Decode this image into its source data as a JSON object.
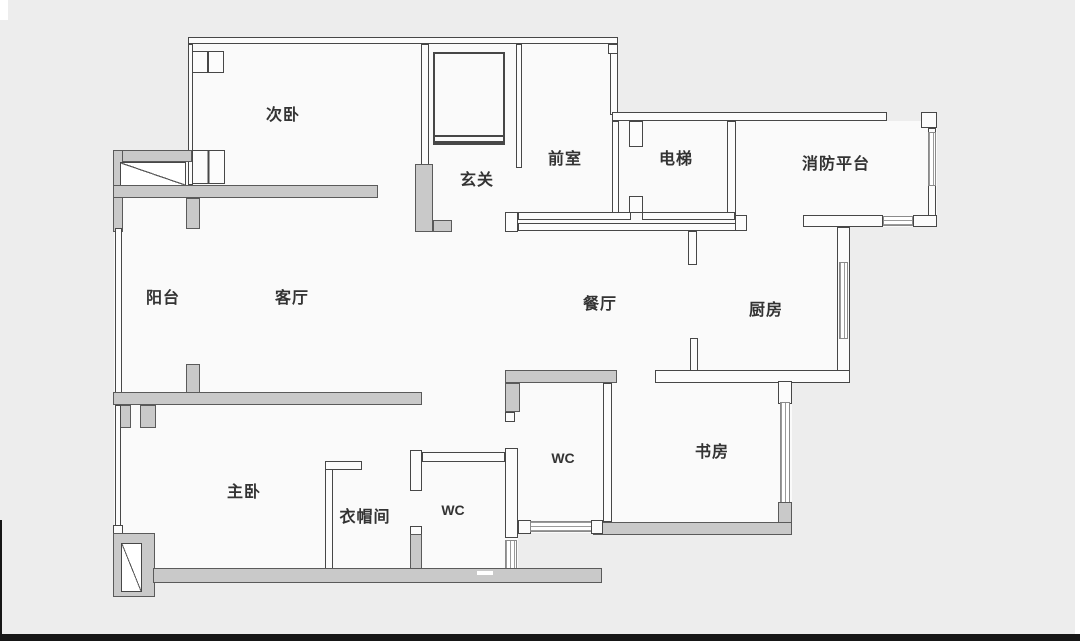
{
  "floorplan": {
    "type": "apartment-floor-plan",
    "colors": {
      "background": "#ededed",
      "floor": "#fafafa",
      "wall_line": "#474747",
      "gray_wall": "#c9c9c9",
      "label_text": "#333333"
    },
    "rooms": [
      {
        "id": "secondary-bedroom",
        "label": "次卧"
      },
      {
        "id": "entryway",
        "label": "玄关"
      },
      {
        "id": "front-room",
        "label": "前室"
      },
      {
        "id": "elevator",
        "label": "电梯"
      },
      {
        "id": "fire-platform",
        "label": "消防平台"
      },
      {
        "id": "balcony",
        "label": "阳台"
      },
      {
        "id": "living-room",
        "label": "客厅"
      },
      {
        "id": "dining-room",
        "label": "餐厅"
      },
      {
        "id": "kitchen",
        "label": "厨房"
      },
      {
        "id": "master-bedroom",
        "label": "主卧"
      },
      {
        "id": "cloakroom",
        "label": "衣帽间"
      },
      {
        "id": "wc-small",
        "label": "WC"
      },
      {
        "id": "wc-main",
        "label": "WC"
      },
      {
        "id": "study",
        "label": "书房"
      }
    ]
  }
}
